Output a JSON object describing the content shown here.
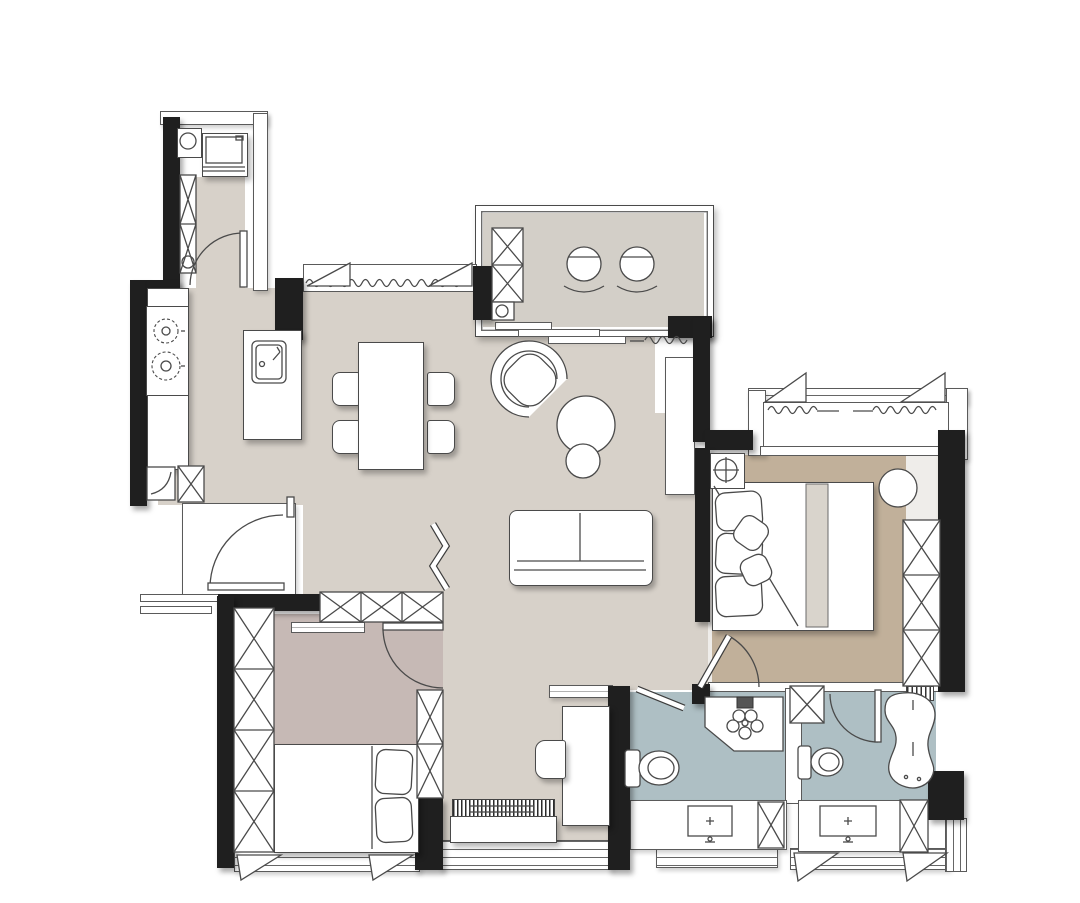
{
  "document": {
    "kind": "architectural floor plan",
    "title": "two-bedroom apartment interior layout plan",
    "text_labels": []
  },
  "palette": {
    "paper": "#ffffff",
    "wall": "#1f1f1f",
    "line": "#4a4a4a",
    "furniture": "#ffffff",
    "floor_main": "#d7d1c9",
    "floor_balcony": "#d3cfc8",
    "floor_master_rug": "#c1b09a",
    "floor_master_base": "#efedea",
    "floor_bedroom2": "#c6b9b5",
    "floor_bath": "#aebfc4",
    "runner": "#d9d4cc"
  },
  "rooms": [
    {
      "id": "entry",
      "name": "entry hall",
      "furniture": [
        "refrigerator",
        "water heater",
        "shoe cabinet",
        "entry swing door"
      ]
    },
    {
      "id": "kitchen",
      "name": "kitchen",
      "furniture": [
        "two-burner stove",
        "counter run",
        "island with sink",
        "base sink cabinet",
        "storage cabinet"
      ]
    },
    {
      "id": "dining",
      "name": "dining area",
      "furniture": [
        "rectangular dining table",
        "four chairs",
        "window with curtain"
      ]
    },
    {
      "id": "living",
      "name": "living room",
      "furniture": [
        "two-seat sofa",
        "curved lounge armchair",
        "nesting round coffee tables",
        "zigzag folding screen"
      ]
    },
    {
      "id": "balcony",
      "name": "leisure balcony",
      "furniture": [
        "two round lounge chairs",
        "storage cabinet",
        "stacking sliding door",
        "curtain"
      ]
    },
    {
      "id": "master_bedroom",
      "name": "master bedroom",
      "furniture": [
        "double bed with runner",
        "area rug",
        "built-in wardrobe",
        "round side table",
        "plant stand",
        "bay window with curtains",
        "pocket sliding door"
      ]
    },
    {
      "id": "bedroom2",
      "name": "second bedroom",
      "furniture": [
        "bed with pillows",
        "built-in wardrobe",
        "overhead cabinet",
        "tv shelf",
        "side cabinet",
        "swing door",
        "casement window"
      ]
    },
    {
      "id": "study",
      "name": "study corner",
      "furniture": [
        "writing desk",
        "chair",
        "upright piano",
        "wall shelf"
      ]
    },
    {
      "id": "bath_shared",
      "name": "shared bathroom",
      "furniture": [
        "toilet",
        "corner shower with head",
        "vanity with sink",
        "storage column",
        "swing door"
      ]
    },
    {
      "id": "bath_master",
      "name": "master bathroom",
      "furniture": [
        "toilet",
        "freeform bathtub",
        "floor grate",
        "vanity with sink",
        "storage column",
        "wall niche",
        "swing door"
      ]
    }
  ]
}
